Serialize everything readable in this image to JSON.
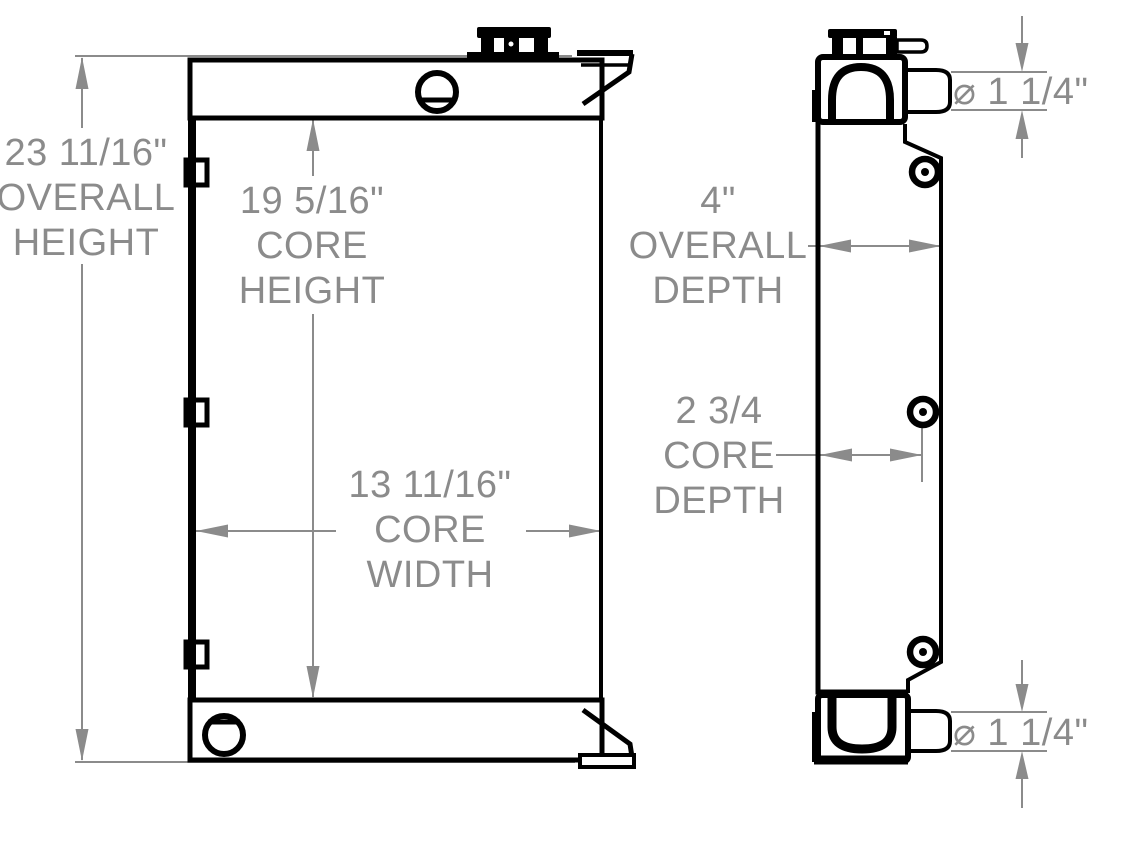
{
  "drawing": {
    "type": "radiator-technical-drawing",
    "colors": {
      "outline": "#000000",
      "dimension": "#8b8b8b",
      "background": "#ffffff"
    },
    "dimensions": {
      "overall_height": {
        "value": "23 11/16\"",
        "label_line_1": "OVERALL",
        "label_line_2": "HEIGHT"
      },
      "core_height": {
        "value": "19 5/16\"",
        "label_line_1": "CORE",
        "label_line_2": "HEIGHT"
      },
      "core_width": {
        "value": "13 11/16\"",
        "label_line_1": "CORE",
        "label_line_2": "WIDTH"
      },
      "overall_depth": {
        "value": "4\"",
        "label_line_1": "OVERALL",
        "label_line_2": "DEPTH"
      },
      "core_depth": {
        "value": "2 3/4",
        "label_line_1": "CORE",
        "label_line_2": "DEPTH"
      },
      "top_port_diameter": {
        "value": "⌀ 1 1/4\""
      },
      "bottom_port_diameter": {
        "value": "⌀ 1 1/4\""
      }
    }
  }
}
